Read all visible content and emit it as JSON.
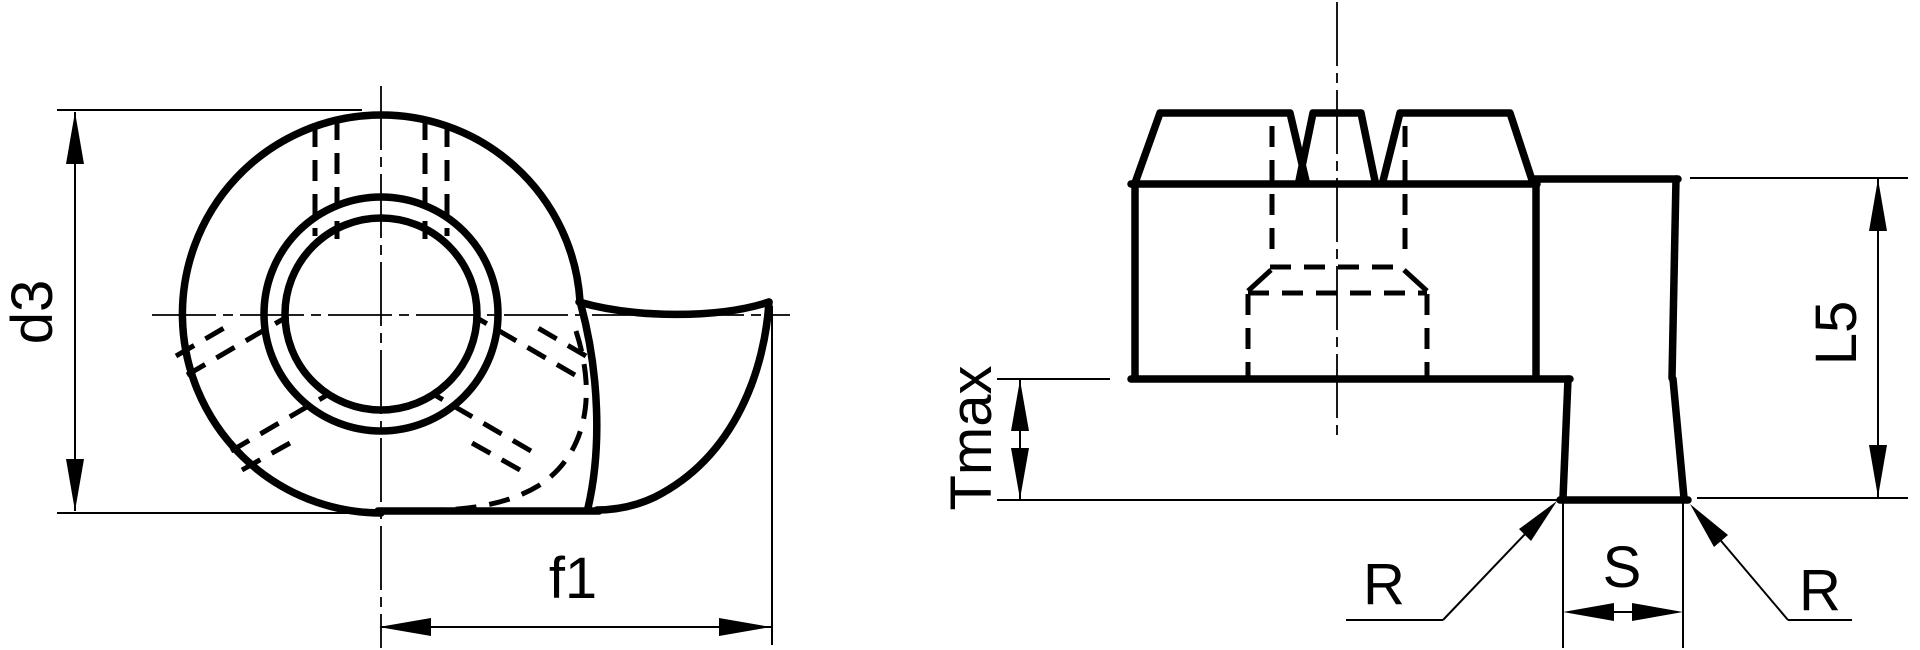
{
  "drawing": {
    "background_color": "#ffffff",
    "line_color": "#000000",
    "front_view": {
      "dimension_labels": {
        "diameter": "d3",
        "cam_length": "f1"
      }
    },
    "side_view": {
      "dimension_labels": {
        "throw": "Tmax",
        "height": "L5",
        "width": "S",
        "radius_left": "R",
        "radius_right": "R"
      }
    }
  }
}
